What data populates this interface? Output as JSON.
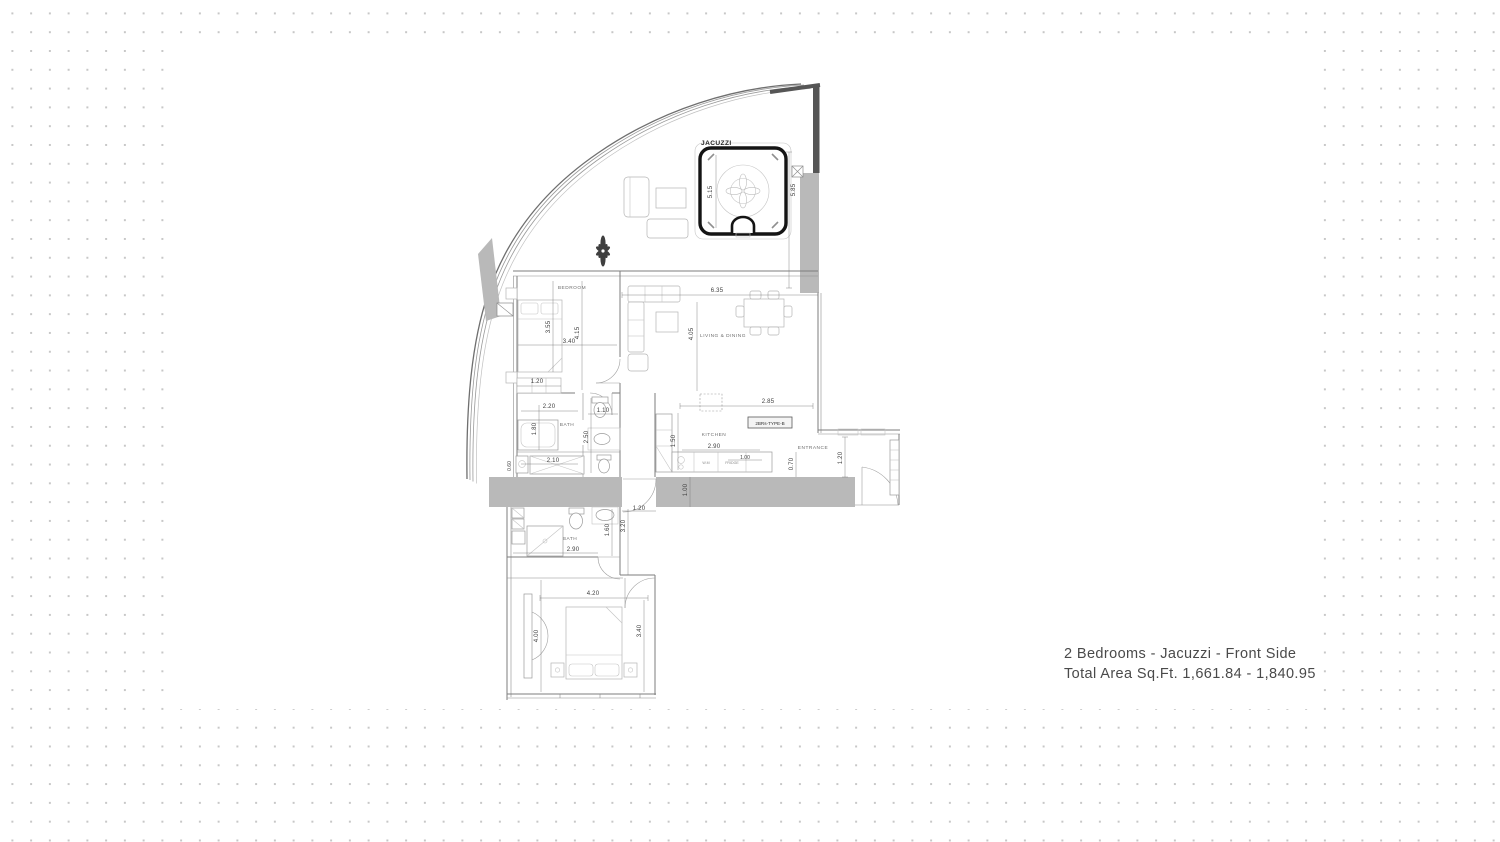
{
  "caption": {
    "line1": "2 Bedrooms - Jacuzzi - Front Side",
    "line2": "Total Area Sq.Ft. 1,661.84 - 1,840.95"
  },
  "plan": {
    "type_tag": "2BRs-TYPE-B",
    "labels": {
      "jacuzzi": "JACUZZI",
      "bedroom_top": "BEDROOM",
      "living_dining": "LIVING & DINING",
      "bath_top": "BATH",
      "kitchen": "KITCHEN",
      "entrance": "ENTRANCE",
      "bath_lower": "BATH",
      "bedroom_lower": "BEDROOM",
      "wm": "W.M",
      "fridge": "FRIDGE"
    },
    "dims": {
      "jacuzzi_width": "5.15",
      "terrace_height": "5.85",
      "bed1_depth": "3.55",
      "bed1_width": "3.40",
      "bed1_depth2": "4.15",
      "bed1_closet": "1.20",
      "living_width": "6.35",
      "living_height": "4.05",
      "bath1_width": "2.20",
      "bath1_niche": "1.10",
      "bath1_height": "1.80",
      "bath1_height2": "2.50",
      "bath1_tub": "2.10",
      "bath1_side": "0.60",
      "kitchen_side": "1.50",
      "kitchen_top": "2.85",
      "kitchen_width": "2.90",
      "kitchen_counter": "1.00",
      "entrance_depth": "0.70",
      "entrance_width": "1.20",
      "corridor_depth": "1.00",
      "corridor_width": "1.20",
      "bath2_height": "3.20",
      "bath2_niche": "1.60",
      "bath2_width": "2.90",
      "bed2_width": "4.20",
      "bed2_height": "4.00",
      "bed2_height2": "3.40"
    }
  }
}
